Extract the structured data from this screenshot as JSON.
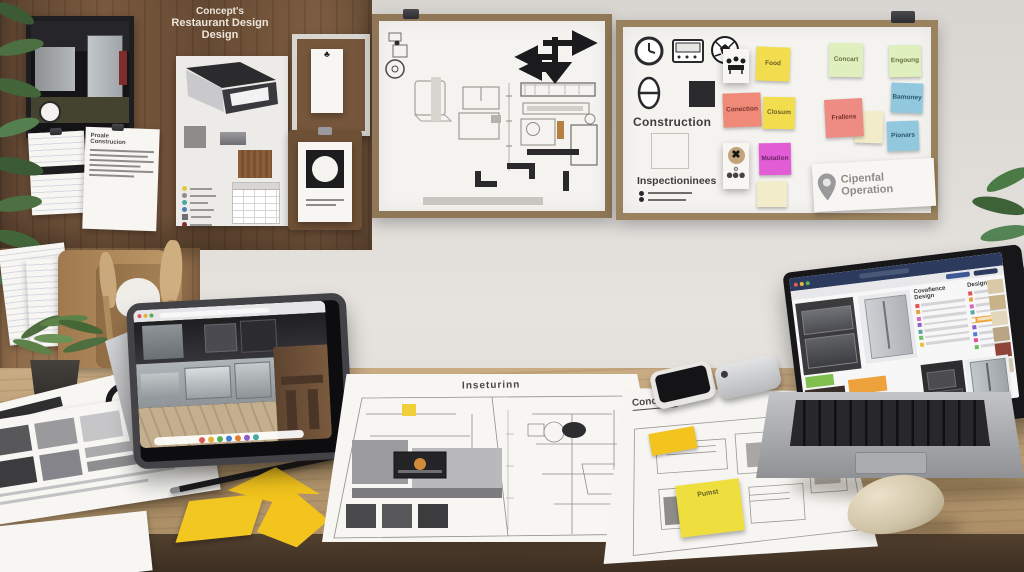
{
  "pinboard": {
    "title": {
      "line1": "Concept's",
      "line2": "Restaurant Design",
      "line3": "Design"
    },
    "document": {
      "line1": "Proale",
      "line2": "Construcion"
    }
  },
  "whiteboard_right": {
    "construction_label": "Construction",
    "inspection_label": "Inspectioninees",
    "sign": {
      "line1": "Cipenfal",
      "line2": "Operation"
    },
    "stickies": [
      {
        "label": "Food",
        "color": "#f2dd4e"
      },
      {
        "label": "Conection",
        "color": "#ef8a79"
      },
      {
        "label": "Closum",
        "color": "#f2dd4e"
      },
      {
        "label": "Mutation",
        "color": "#e25cd5"
      },
      {
        "label": "Concart",
        "color": "#e0efbe"
      },
      {
        "label": "Frallens",
        "color": "#ee8c84"
      },
      {
        "label": "Engoung",
        "color": "#e0efbe"
      },
      {
        "label": "Bamoney",
        "color": "#92c8de"
      },
      {
        "label": "Pionars",
        "color": "#92c8de"
      }
    ]
  },
  "desk": {
    "blueprint_main_title": "Inseturinn",
    "blueprint_right_title": "Concelist",
    "sticky_note_label": "Pumst"
  },
  "laptop_screen": {
    "heading_left": "Covafience Design",
    "heading_right": "Design"
  },
  "colors": {
    "wall": "#dedbd7",
    "desk_wood": "#bda076",
    "desk_edge": "#4a3a2c",
    "panel_wood": "#6e5139",
    "whiteboard_frame": "#8f7758",
    "sticky_yellow": "#f2dd4e",
    "sticky_salmon": "#ef8a79",
    "sticky_magenta": "#e25cd5",
    "sticky_green": "#e0efbe",
    "sticky_blue": "#92c8de",
    "laptop_topbar": "#2c3b5d",
    "accent_orange": "#eda23b",
    "accent_magenta": "#cf58c4",
    "accent_green": "#7fbf4d",
    "arrow_sticky_yellow": "#f2c41d"
  }
}
